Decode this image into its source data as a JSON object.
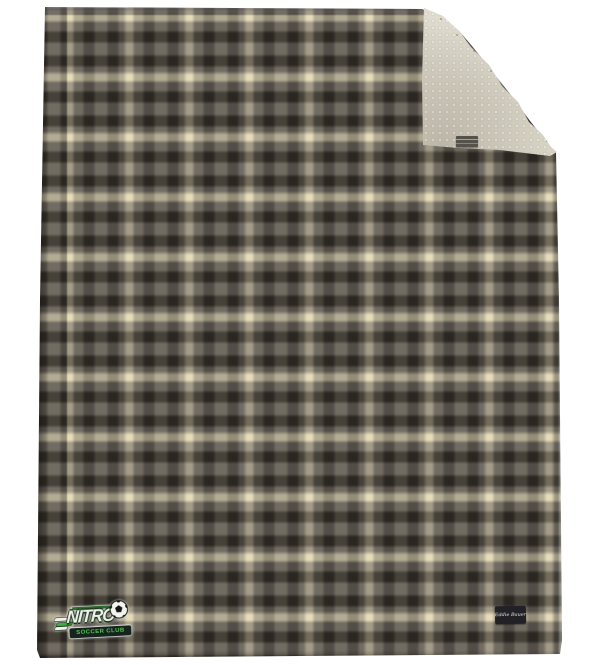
{
  "scene": {
    "description": "Product photo of a gray windowpane-plaid fleece blanket with cream sherpa reverse; top-right corner folded over to show the sherpa side",
    "background_color": "#ffffff"
  },
  "blanket": {
    "front_pattern": {
      "type": "windowpane plaid",
      "base_gray": "#767065",
      "dark_stripe": "#312d27",
      "cream_stripe": "#e6dcba",
      "stripe_period_px": 60
    },
    "reverse": {
      "material": "sherpa fleece",
      "color": "#d8d4c6"
    },
    "fold": {
      "corner": "top-right"
    },
    "care_tag_color": "#55524c"
  },
  "decoration": {
    "nitro_logo": {
      "title": "NITRO",
      "subtitle": "SOCCER CLUB",
      "accent_green": "#3fae3f",
      "banner_bg": "#15241c",
      "icon": "soccer-ball"
    },
    "brand_label": {
      "text": "Eddie Bauer",
      "bg": "#222226",
      "text_color": "#e6e4dc"
    }
  }
}
